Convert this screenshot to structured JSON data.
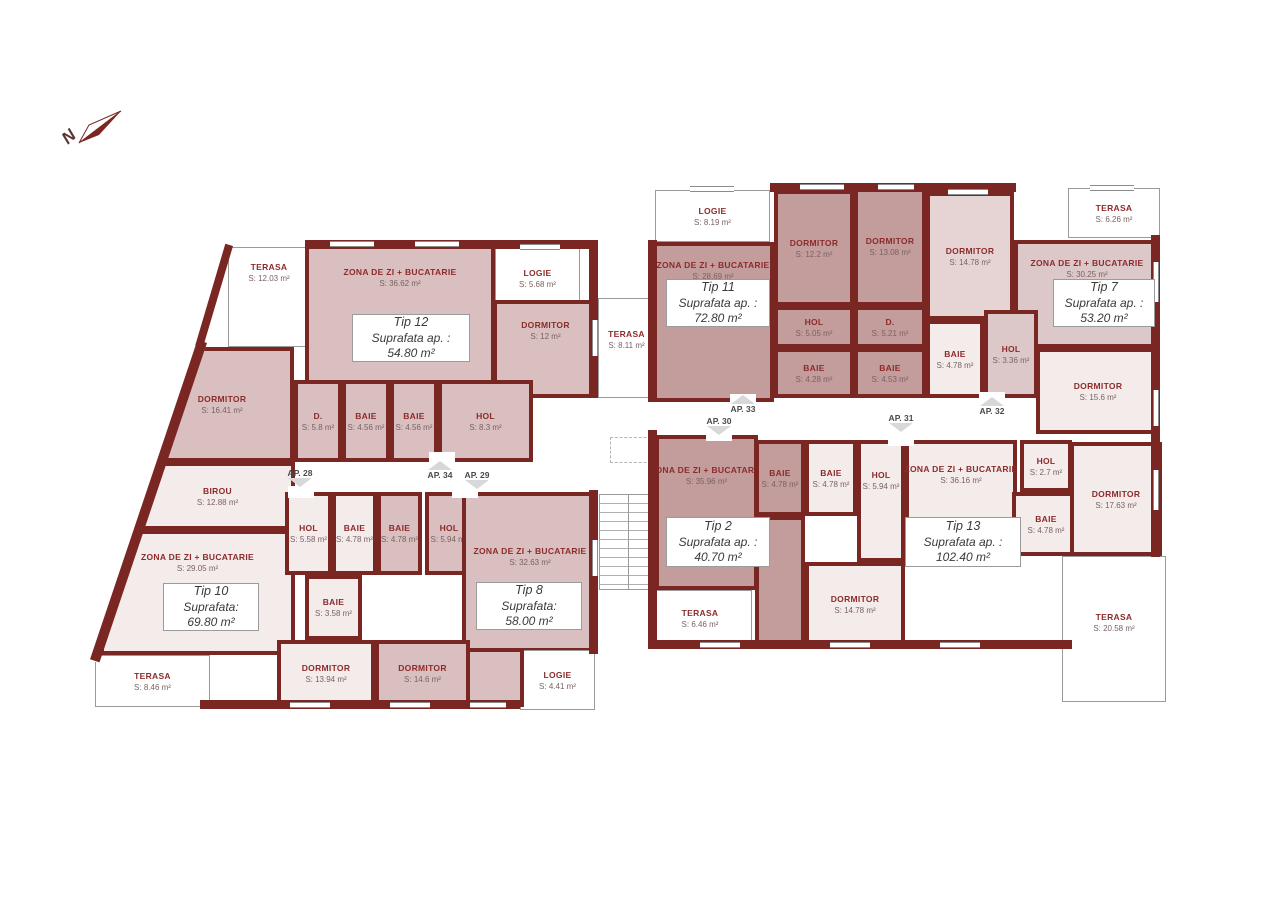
{
  "north_indicator": {
    "label": "N",
    "icon": "north-arrow-icon"
  },
  "colors": {
    "wall": "#7a2723",
    "fill_dark": "#c39c9c",
    "fill_medium": "#d9bfbf",
    "fill_medium_light": "#dcc8c8",
    "fill_light": "#e6d4d4",
    "fill_pale": "#f4ebeb",
    "terrace_fill": "#ffffff",
    "room_name_text": "#8d2b2b",
    "area_text": "#7a6262",
    "apartment_box_text": "#3a3a3a"
  },
  "apartments": [
    {
      "id": "tip12",
      "name": "Tip 12",
      "line2": "Suprafata ap. :",
      "area": "54.80 m²"
    },
    {
      "id": "tip10",
      "name": "Tip 10",
      "line2": "Suprafata:",
      "area": "69.80 m²"
    },
    {
      "id": "tip8",
      "name": "Tip 8",
      "line2": "Suprafata:",
      "area": "58.00 m²"
    },
    {
      "id": "tip11",
      "name": "Tip 11",
      "line2": "Suprafata ap. :",
      "area": "72.80 m²"
    },
    {
      "id": "tip7",
      "name": "Tip 7",
      "line2": "Suprafata ap. :",
      "area": "53.20 m²"
    },
    {
      "id": "tip2",
      "name": "Tip 2",
      "line2": "Suprafata ap. :",
      "area": "40.70 m²"
    },
    {
      "id": "tip13",
      "name": "Tip 13",
      "line2": "Suprafata ap. :",
      "area": "102.40 m²"
    }
  ],
  "ap_markers": [
    {
      "id": "ap28",
      "label": "AP. 28"
    },
    {
      "id": "ap34",
      "label": "AP. 34"
    },
    {
      "id": "ap29",
      "label": "AP. 29"
    },
    {
      "id": "ap33",
      "label": "AP. 33"
    },
    {
      "id": "ap30",
      "label": "AP. 30"
    },
    {
      "id": "ap31",
      "label": "AP. 31"
    },
    {
      "id": "ap32",
      "label": "AP. 32"
    }
  ],
  "rooms": [
    {
      "id": "t12-terasa",
      "name": "TERASA",
      "area": "S: 12.03 m²"
    },
    {
      "id": "t12-zona",
      "name": "ZONA DE ZI + BUCATARIE",
      "area": "S: 36.62 m²"
    },
    {
      "id": "t12-logie",
      "name": "LOGIE",
      "area": "S: 5.68 m²"
    },
    {
      "id": "t12-dorm2",
      "name": "DORMITOR",
      "area": "S: 12 m²"
    },
    {
      "id": "t12-dorm1",
      "name": "DORMITOR",
      "area": "S: 16.41 m²"
    },
    {
      "id": "t12-d",
      "name": "D.",
      "area": "S: 5.8 m²"
    },
    {
      "id": "t12-baie1",
      "name": "BAIE",
      "area": "S: 4.56 m²"
    },
    {
      "id": "t12-baie2",
      "name": "BAIE",
      "area": "S: 4.56 m²"
    },
    {
      "id": "t12-hol",
      "name": "HOL",
      "area": "S: 8.3 m²"
    },
    {
      "id": "t10-birou",
      "name": "BIROU",
      "area": "S: 12.88 m²"
    },
    {
      "id": "t10-zona",
      "name": "ZONA DE ZI + BUCATARIE",
      "area": "S: 29.05 m²"
    },
    {
      "id": "t10-hol",
      "name": "HOL",
      "area": "S: 5.58 m²"
    },
    {
      "id": "t10-baie1",
      "name": "BAIE",
      "area": "S: 4.78 m²"
    },
    {
      "id": "t10-baie2",
      "name": "BAIE",
      "area": "S: 3.58 m²"
    },
    {
      "id": "t10-dorm",
      "name": "DORMITOR",
      "area": "S: 13.94 m²"
    },
    {
      "id": "t10-terasa",
      "name": "TERASA",
      "area": "S: 8.46 m²"
    },
    {
      "id": "t8-baie",
      "name": "BAIE",
      "area": "S: 4.78 m²"
    },
    {
      "id": "t8-hol",
      "name": "HOL",
      "area": "S: 5.94 m²"
    },
    {
      "id": "t8-zona",
      "name": "ZONA DE ZI + BUCATARIE",
      "area": "S: 32.63 m²"
    },
    {
      "id": "t8-dorm",
      "name": "DORMITOR",
      "area": "S: 14.6 m²"
    },
    {
      "id": "t8-logie",
      "name": "LOGIE",
      "area": "S: 4.41 m²"
    },
    {
      "id": "mid-terasa",
      "name": "TERASA",
      "area": "S: 8.11 m²"
    },
    {
      "id": "t11-logie",
      "name": "LOGIE",
      "area": "S: 8.19 m²"
    },
    {
      "id": "t11-zona",
      "name": "ZONA DE ZI + BUCATARIE",
      "area": "S: 28.69 m²"
    },
    {
      "id": "t11-dorm1",
      "name": "DORMITOR",
      "area": "S: 12.2 m²"
    },
    {
      "id": "t11-dorm2",
      "name": "DORMITOR",
      "area": "S: 13.08 m²"
    },
    {
      "id": "t11-hol",
      "name": "HOL",
      "area": "S: 5.05 m²"
    },
    {
      "id": "t11-d",
      "name": "D.",
      "area": "S: 5.21 m²"
    },
    {
      "id": "t11-baie1",
      "name": "BAIE",
      "area": "S: 4.28 m²"
    },
    {
      "id": "t11-baie2",
      "name": "BAIE",
      "area": "S: 4.53 m²"
    },
    {
      "id": "t7-terasa",
      "name": "TERASA",
      "area": "S: 6.26 m²"
    },
    {
      "id": "t7-dorm1",
      "name": "DORMITOR",
      "area": "S: 14.78 m²"
    },
    {
      "id": "t7-zona",
      "name": "ZONA DE ZI + BUCATARIE",
      "area": "S: 30.25 m²"
    },
    {
      "id": "t7-baie",
      "name": "BAIE",
      "area": "S: 4.78 m²"
    },
    {
      "id": "t7-hol",
      "name": "HOL",
      "area": "S: 3.36 m²"
    },
    {
      "id": "t7-dorm2",
      "name": "DORMITOR",
      "area": "S: 15.6 m²"
    },
    {
      "id": "t2-zona",
      "name": "ZONA DE ZI + BUCATARIE",
      "area": "S: 35.96 m²"
    },
    {
      "id": "t2-baie",
      "name": "BAIE",
      "area": "S: 4.78 m²"
    },
    {
      "id": "t2-terasa",
      "name": "TERASA",
      "area": "S: 6.46 m²"
    },
    {
      "id": "t13-baie1",
      "name": "BAIE",
      "area": "S: 4.78 m²"
    },
    {
      "id": "t13-hol1",
      "name": "HOL",
      "area": "S: 5.94 m²"
    },
    {
      "id": "t13-zona",
      "name": "ZONA DE ZI + BUCATARIE",
      "area": "S: 36.16 m²"
    },
    {
      "id": "t13-dorm1",
      "name": "DORMITOR",
      "area": "S: 14.78 m²"
    },
    {
      "id": "t13-hol2",
      "name": "HOL",
      "area": "S: 2.7 m²"
    },
    {
      "id": "t13-baie2",
      "name": "BAIE",
      "area": "S: 4.78 m²"
    },
    {
      "id": "t13-dorm2",
      "name": "DORMITOR",
      "area": "S: 17.63 m²"
    },
    {
      "id": "t13-terasa",
      "name": "TERASA",
      "area": "S: 20.58 m²"
    }
  ]
}
